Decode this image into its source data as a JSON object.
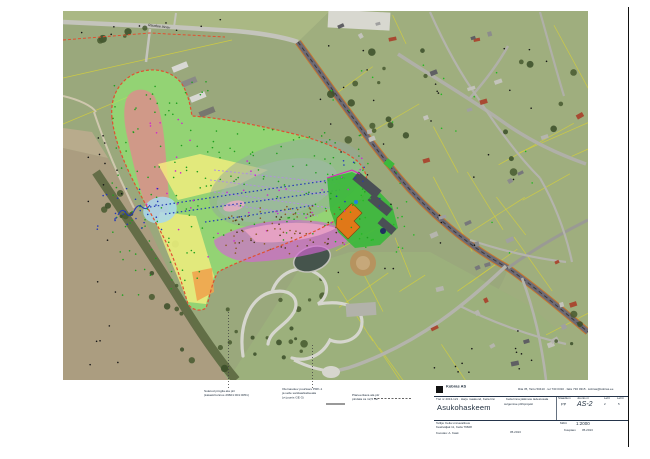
{
  "page": {
    "background": "#ffffff",
    "frame_color": "#111111"
  },
  "map": {
    "road_label": "Raudtee tänav",
    "overlay_colors": {
      "green_zone": "#90ee70",
      "boundary_dash": "#e05030",
      "red_zone": "#de8c8c",
      "yellow_zone": "#f6ef7e",
      "orange_zone": "#f0a44e",
      "blue_zone": "#a8d8ee",
      "magenta_zone": "#d565d5",
      "pink_zone": "#f2a8c8",
      "grey_oval": "#93a89c",
      "school_green": "#3cb83c",
      "building_orange": "#e07818"
    },
    "texture": {
      "parcels": {
        "n": 26,
        "color": "#d6d03a",
        "region": [
          318,
          12,
          268,
          355
        ]
      },
      "houses": {
        "n": 40,
        "regions": [
          [
            332,
            14,
            250,
            188
          ],
          [
            428,
            206,
            155,
            160
          ]
        ],
        "colors": [
          "#8c8c8c",
          "#a0a0a0",
          "#5f5f63",
          "#b5b5ad",
          "#a84a32",
          "#c3c3bb",
          "#77777b"
        ],
        "size": [
          4,
          8,
          3,
          5
        ]
      },
      "trees": [
        {
          "r": [
            330,
            45,
            100,
            100
          ],
          "n": 14
        },
        {
          "r": [
            235,
            275,
            100,
            85
          ],
          "n": 16
        },
        {
          "r": [
            100,
            180,
            40,
            60
          ],
          "n": 6
        },
        {
          "r": [
            140,
            240,
            40,
            70
          ],
          "n": 6
        },
        {
          "r": [
            180,
            300,
            50,
            78
          ],
          "n": 7
        },
        {
          "r": [
            555,
            290,
            28,
            60
          ],
          "n": 4
        },
        {
          "r": [
            70,
            28,
            80,
            14
          ],
          "n": 5
        },
        {
          "r": [
            500,
            60,
            80,
            120
          ],
          "n": 8
        }
      ],
      "dots": [
        {
          "c": "#1fa01f",
          "n": 90,
          "r": [
            108,
            78,
            100,
            225
          ]
        },
        {
          "c": "#1fa01f",
          "n": 85,
          "r": [
            178,
            128,
            190,
            112
          ]
        },
        {
          "c": "#22b822",
          "n": 28,
          "r": [
            322,
            162,
            88,
            92
          ]
        },
        {
          "c": "#22b822",
          "n": 20,
          "r": [
            330,
            64,
            210,
            200
          ]
        },
        {
          "c": "#cf24cf",
          "n": 30,
          "r": [
            152,
            152,
            215,
            106
          ]
        },
        {
          "c": "#cf24cf",
          "n": 12,
          "r": [
            142,
            102,
            58,
            108
          ]
        },
        {
          "c": "#2338b8",
          "n": 26,
          "r": [
            96,
            188,
            66,
            42
          ]
        },
        {
          "c": "#2338b8",
          "n": 10,
          "r": [
            336,
            152,
            62,
            58
          ]
        },
        {
          "c": "#8a5a22",
          "n": 55,
          "r": [
            226,
            206,
            118,
            48
          ]
        },
        {
          "c": "#4a3418",
          "n": 26,
          "r": [
            232,
            216,
            106,
            34
          ]
        },
        {
          "c": "#151515",
          "n": 18,
          "r": [
            88,
            100,
            36,
            270
          ]
        },
        {
          "c": "#151515",
          "n": 30,
          "r": [
            300,
            44,
            258,
            244
          ]
        },
        {
          "c": "#151515",
          "n": 12,
          "r": [
            420,
            330,
            150,
            44
          ]
        },
        {
          "c": "#151515",
          "n": 8,
          "r": [
            70,
            14,
            190,
            26
          ]
        }
      ]
    }
  },
  "annotations": {
    "a": {
      "lines": [
        "Suletud prügila ala piir",
        "(katastritunnus 29601:001:0051)"
      ]
    },
    "b": {
      "lines": [
        "Olemasolev puurkaev PRK-1",
        "ja selle sanitaarkaitseala",
        "(vt joonis GE-3)"
      ]
    },
    "c": {
      "lines": [
        "Planeeritava ala piir",
        "pindala ca 12,5 ha"
      ]
    }
  },
  "title_block": {
    "company": "Kobras AS",
    "contact": "Riia 35, Tartu 50410 · tel 730 0310 · faks 730 0315 · kobras@kobras.ee",
    "job_line": "Töö nr 2013-121 · Harju maakond, Keila linn",
    "title_big": "Asukohaskeem",
    "project_line1": "Keila linna jäätmete ladestusala",
    "project_line2": "sulgemise põhiprojekt",
    "stage_label": "Staadium",
    "stage_value": "PP",
    "sheet_label": "Joonis nr",
    "sheet_value": "AS-2",
    "leht_label": "Leht",
    "leht_value": "2",
    "lehti_label": "Lehti",
    "lehti_value": "5",
    "client_line1": "Tellija: Keila Linnavalitsus",
    "client_line2": "Keskväljak 11, Keila 76608",
    "author_line": "Koostas: A. Kask",
    "center_note": "05.2013",
    "scale_label": "Mõõt",
    "scale_value": "1:2000",
    "date_label": "Kuupäev",
    "date_value": "05.2013"
  }
}
